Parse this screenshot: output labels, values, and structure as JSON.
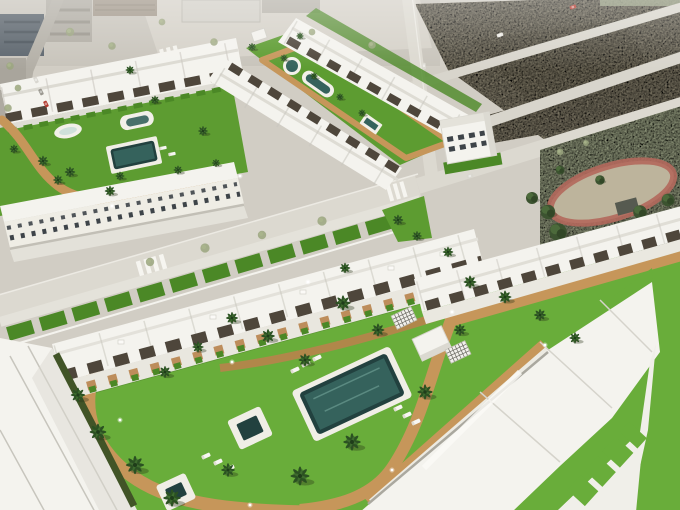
{
  "meta": {
    "image_type": "3d-architectural-aerial-render",
    "summary": "Bird's-eye 3D render of a white townhouse development with communal lawns, pools, tan walking paths and palm trees, bordered by roads, a vacant dirt lot and a tree park; faded existing town at the top edge."
  },
  "palette": {
    "base": "#d1cdc4",
    "city": "#c8c4bb",
    "plaza": "#d5d1c8",
    "road": "#dcd9d0",
    "road_minor": "#d2cfc6",
    "curb": "#f7f6f1",
    "sidewalk": "#e6e4dc",
    "dirt": "#a69e87",
    "dirt_dark": "#948c75",
    "pale_lot": "#ccc8bf",
    "park_lawn": "#b6bf9c",
    "track": "#b2685c",
    "grass": "#5d9c31",
    "grass_deep": "#4b8826",
    "grass_bright": "#69ad3a",
    "path": "#c6965a",
    "path_deep": "#b8834c",
    "pool_deep": "#22413f",
    "pool_mid": "#35625c",
    "pool_light": "#7fb2a5",
    "white_roof": "#f4f3ee",
    "white_shade": "#e3e1d9",
    "facade": "#efede5",
    "seam": "#c7c5bd",
    "pergola": "#4e463b",
    "window": "#3e4449",
    "hedge": "#415427",
    "dark_building": "#5b646c",
    "hut": "#565a50",
    "car_red": "#b23a2e"
  },
  "scene": {
    "regions": [
      {
        "id": "existing-town",
        "kind": "faded aerial photo strip"
      },
      {
        "id": "vacant-dirt-lot",
        "kind": "empty plot with perimeter roads"
      },
      {
        "id": "tree-park",
        "kind": "park with red oval track"
      },
      {
        "id": "upper-left-block",
        "kind": "townhouse block with garden and 3 pools"
      },
      {
        "id": "upper-middle-block",
        "kind": "townhouse rows flanking long pool garden"
      },
      {
        "id": "detached-building",
        "kind": "three storey corner building"
      },
      {
        "id": "west-facade-row",
        "kind": "street-facing townhouses"
      },
      {
        "id": "foreground-block",
        "kind": "main community: house rows, garden, main pool, two spas"
      }
    ],
    "instances": {
      "palms": {
        "symbol": "#sym-palm",
        "items": [
          {
            "x": 130,
            "y": 70,
            "s": 0.6
          },
          {
            "x": 155,
            "y": 100,
            "s": 0.6
          },
          {
            "x": 203,
            "y": 131,
            "s": 0.65
          },
          {
            "x": 43,
            "y": 161,
            "s": 0.7
          },
          {
            "x": 70,
            "y": 172,
            "s": 0.7
          },
          {
            "x": 110,
            "y": 191,
            "s": 0.7
          },
          {
            "x": 14,
            "y": 149,
            "s": 0.6
          },
          {
            "x": 58,
            "y": 180,
            "s": 0.65
          },
          {
            "x": 120,
            "y": 176,
            "s": 0.6
          },
          {
            "x": 178,
            "y": 170,
            "s": 0.6
          },
          {
            "x": 216,
            "y": 163,
            "s": 0.55
          },
          {
            "x": 252,
            "y": 47,
            "s": 0.55
          },
          {
            "x": 284,
            "y": 58,
            "s": 0.5
          },
          {
            "x": 314,
            "y": 76,
            "s": 0.5
          },
          {
            "x": 340,
            "y": 97,
            "s": 0.5
          },
          {
            "x": 362,
            "y": 113,
            "s": 0.5
          },
          {
            "x": 300,
            "y": 36,
            "s": 0.5
          },
          {
            "x": 398,
            "y": 220,
            "s": 0.7
          },
          {
            "x": 417,
            "y": 236,
            "s": 0.65
          },
          {
            "x": 448,
            "y": 252,
            "s": 0.7
          },
          {
            "x": 345,
            "y": 268,
            "s": 0.7
          },
          {
            "x": 232,
            "y": 318,
            "s": 0.8
          },
          {
            "x": 268,
            "y": 336,
            "s": 0.9
          },
          {
            "x": 305,
            "y": 360,
            "s": 0.85
          },
          {
            "x": 343,
            "y": 303,
            "s": 1.0
          },
          {
            "x": 378,
            "y": 330,
            "s": 0.85
          },
          {
            "x": 198,
            "y": 347,
            "s": 0.75
          },
          {
            "x": 165,
            "y": 372,
            "s": 0.8
          },
          {
            "x": 300,
            "y": 476,
            "s": 1.25
          },
          {
            "x": 352,
            "y": 442,
            "s": 1.15
          },
          {
            "x": 425,
            "y": 392,
            "s": 1.0
          },
          {
            "x": 98,
            "y": 432,
            "s": 1.1
          },
          {
            "x": 135,
            "y": 465,
            "s": 1.2
          },
          {
            "x": 172,
            "y": 498,
            "s": 1.15
          },
          {
            "x": 78,
            "y": 395,
            "s": 0.95
          },
          {
            "x": 228,
            "y": 470,
            "s": 0.9
          },
          {
            "x": 470,
            "y": 282,
            "s": 0.85
          },
          {
            "x": 505,
            "y": 297,
            "s": 0.85
          },
          {
            "x": 540,
            "y": 315,
            "s": 0.8
          },
          {
            "x": 575,
            "y": 338,
            "s": 0.75
          },
          {
            "x": 460,
            "y": 330,
            "s": 0.8
          }
        ]
      },
      "park-trees": {
        "symbol": "#sym-tree",
        "items": [
          {
            "x": 558,
            "y": 232,
            "s": 1.1
          },
          {
            "x": 578,
            "y": 246,
            "s": 1.3
          },
          {
            "x": 600,
            "y": 238,
            "s": 1.2
          },
          {
            "x": 622,
            "y": 252,
            "s": 1.4
          },
          {
            "x": 645,
            "y": 246,
            "s": 1.2
          },
          {
            "x": 664,
            "y": 258,
            "s": 1.1
          },
          {
            "x": 678,
            "y": 242,
            "s": 1.0
          },
          {
            "x": 590,
            "y": 264,
            "s": 1.1
          },
          {
            "x": 615,
            "y": 270,
            "s": 1.2
          },
          {
            "x": 548,
            "y": 212,
            "s": 0.9
          },
          {
            "x": 640,
            "y": 212,
            "s": 0.85
          },
          {
            "x": 668,
            "y": 200,
            "s": 0.8
          },
          {
            "x": 532,
            "y": 198,
            "s": 0.75
          },
          {
            "x": 676,
            "y": 292,
            "s": 0.95
          },
          {
            "x": 654,
            "y": 296,
            "s": 0.9
          },
          {
            "x": 600,
            "y": 180,
            "s": 0.6
          },
          {
            "x": 560,
            "y": 170,
            "s": 0.55
          }
        ]
      },
      "street-trees": {
        "symbol": "#sym-streettree",
        "items": [
          {
            "x": 70,
            "y": 32,
            "s": 1
          },
          {
            "x": 112,
            "y": 46,
            "s": 0.9
          },
          {
            "x": 162,
            "y": 22,
            "s": 0.8
          },
          {
            "x": 214,
            "y": 42,
            "s": 0.9
          },
          {
            "x": 312,
            "y": 32,
            "s": 0.8
          },
          {
            "x": 372,
            "y": 45,
            "s": 0.9
          },
          {
            "x": 150,
            "y": 262,
            "s": 1
          },
          {
            "x": 205,
            "y": 248,
            "s": 1.1
          },
          {
            "x": 262,
            "y": 235,
            "s": 1
          },
          {
            "x": 322,
            "y": 221,
            "s": 1.1
          },
          {
            "x": 560,
            "y": 152,
            "s": 0.8
          },
          {
            "x": 586,
            "y": 143,
            "s": 0.7
          },
          {
            "x": 10,
            "y": 66,
            "s": 0.9
          },
          {
            "x": 18,
            "y": 88,
            "s": 0.8
          },
          {
            "x": 8,
            "y": 108,
            "s": 0.9
          }
        ]
      },
      "bare-trees": {
        "symbol": "#sym-bare",
        "items": [
          {
            "x": 662,
            "y": 332,
            "s": 1.0
          },
          {
            "x": 670,
            "y": 398,
            "s": 1.2
          },
          {
            "x": 652,
            "y": 464,
            "s": 1.1
          },
          {
            "x": 678,
            "y": 290,
            "s": 0.9
          }
        ]
      },
      "loungers": {
        "symbol": "#sym-lounger",
        "items": [
          {
            "x": 295,
            "y": 370,
            "r": -25
          },
          {
            "x": 306,
            "y": 364,
            "r": -25
          },
          {
            "x": 317,
            "y": 358,
            "r": -25
          },
          {
            "x": 398,
            "y": 408,
            "r": -25
          },
          {
            "x": 407,
            "y": 415,
            "r": -25
          },
          {
            "x": 416,
            "y": 422,
            "r": -25
          },
          {
            "x": 206,
            "y": 456,
            "r": -25
          },
          {
            "x": 218,
            "y": 462,
            "r": -25
          },
          {
            "x": 230,
            "y": 468,
            "r": -25
          },
          {
            "x": 163,
            "y": 148,
            "r": -12,
            "s": 0.8
          },
          {
            "x": 172,
            "y": 154,
            "r": -12,
            "s": 0.8
          }
        ]
      },
      "lamps": {
        "symbol": "#sym-lamp",
        "items": [
          {
            "x": 120,
            "y": 420
          },
          {
            "x": 232,
            "y": 362
          },
          {
            "x": 452,
            "y": 312
          },
          {
            "x": 392,
            "y": 470
          },
          {
            "x": 250,
            "y": 505
          },
          {
            "x": 545,
            "y": 345
          },
          {
            "x": 112,
            "y": 206
          },
          {
            "x": 240,
            "y": 176
          },
          {
            "x": 308,
            "y": 282
          }
        ]
      },
      "cars": {
        "symbol": "#sym-car",
        "items": [
          {
            "x": 573,
            "y": 7,
            "r": -20,
            "fill": "#b23a2e"
          },
          {
            "x": 500,
            "y": 35,
            "r": -20,
            "fill": "#e8e6df"
          },
          {
            "x": 36,
            "y": 80,
            "r": 64,
            "fill": "#d8d6cf"
          },
          {
            "x": 41,
            "y": 92,
            "r": 64,
            "fill": "#9a978f"
          },
          {
            "x": 46,
            "y": 104,
            "r": 64,
            "fill": "#b23a2e"
          },
          {
            "x": 424,
            "y": 66,
            "r": 85,
            "fill": "#dcdad2"
          },
          {
            "x": 470,
            "y": 176,
            "r": -17,
            "fill": "#d9d7cf"
          }
        ]
      },
      "trellis": {
        "symbol": "#sym-trellis",
        "items": [
          {
            "x": 404,
            "y": 318,
            "r": -25,
            "s": 0.9
          },
          {
            "x": 458,
            "y": 352,
            "r": -25,
            "s": 0.9
          }
        ]
      }
    }
  }
}
